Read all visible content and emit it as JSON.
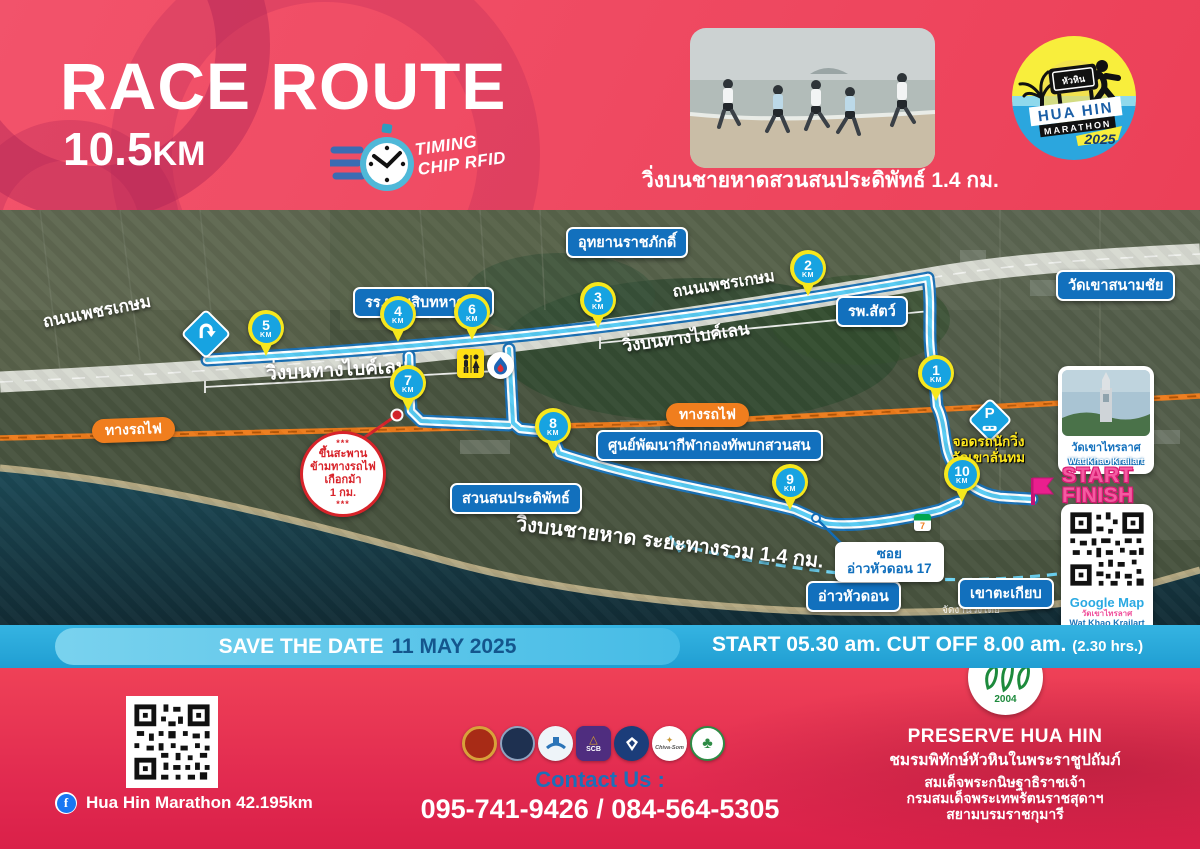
{
  "colors": {
    "header_pink": "#ee4257",
    "banner_blue": "#2fb0e0",
    "label_blue": "#1270bd",
    "route_cyan": "#57cbf3",
    "railway_orange": "#ee7c1c",
    "km_pin_yellow": "#f6e71d",
    "km_pin_blue": "#17a3e1",
    "start_finish_pink": "#f45ba1"
  },
  "header": {
    "title": "RACE ROUTE",
    "distance_value": "10.5",
    "distance_unit": "KM",
    "timing_line1": "TIMING",
    "timing_line2": "CHIP RFID",
    "photo_caption": "วิ่งบนชายหาดสวนสนประดิพัทธ์ 1.4 กม.",
    "logo": {
      "sign": "หัวหิน",
      "name1": "HUA HIN",
      "name2": "MARATHON",
      "year": "2025"
    }
  },
  "map": {
    "km_unit": "KM",
    "km_markers": [
      {
        "n": "1"
      },
      {
        "n": "2"
      },
      {
        "n": "3"
      },
      {
        "n": "4"
      },
      {
        "n": "5"
      },
      {
        "n": "6"
      },
      {
        "n": "7"
      },
      {
        "n": "8"
      },
      {
        "n": "9"
      },
      {
        "n": "10"
      }
    ],
    "road_phetkasem_left": "ถนนเพชรเกษม",
    "road_phetkasem_center": "ถนนเพชรเกษม",
    "railway_left": "ทางรถไฟ",
    "railway_right": "ทางรถไฟ",
    "bike_lane_left": "วิ่งบนทางไบค์เลน",
    "bike_lane_right": "วิ่งบนทางไบค์เลน",
    "beach_run": "วิ่งบนชายหาด ระยะทางรวม 1.4 กม.",
    "labels": {
      "army_school": "รร.นายสิบทหารบก",
      "rajabhakti": "อุทยานราชภักดิ์",
      "vet_hospital": "รพ.สัตว์",
      "wat_khao_sanamchai": "วัดเขาสนามชัย",
      "army_sports_center": "ศูนย์พัฒนากีฬากองทัพบกสวนสน",
      "suan_son": "สวนสนประดิพัทธ์",
      "ao_hua_don": "อ่าวหัวดอน",
      "khao_takiab": "เขาตะเกียบ",
      "soi_line1": "ซอย",
      "soi_line2": "อ่าวหัวดอน 17"
    },
    "parking_note_line1": "จอดรถนักวิ่ง",
    "parking_note_line2": "วัดเขาลั่นทม",
    "parking_icon_letter": "P",
    "seven_eleven": "7",
    "bridge_note": {
      "stars": "***",
      "line1": "ขึ้นสะพาน",
      "line2": "ข้ามทางรถไฟ",
      "line3": "เกือกม้า",
      "line4": "1 กม."
    },
    "start_label": "START",
    "finish_label": "FINISH",
    "temple_card": {
      "thai": "วัดเขาไทรลาศ",
      "eng": "Wat Khao Krailart"
    },
    "qr_card": {
      "title": "Google Map",
      "thai": "วัดเขาไทรลาศ",
      "eng": "Wat Khao Krailart"
    },
    "organizer_note": "จัดงานวิ่งโดย"
  },
  "banner": {
    "save_the_date": "SAVE THE DATE",
    "date": "11 MAY 2025",
    "start_info": "START 05.30 am. CUT OFF 8.00 am.",
    "duration": "(2.30 hrs.)"
  },
  "footer": {
    "facebook": "Hua Hin Marathon 42.195km",
    "contact_label": "Contact Us :",
    "phones": "095-741-9426 / 084-564-5305",
    "sponsors": {
      "scb": "SCB",
      "chiva_som": "Chiva-Som"
    },
    "preserve": {
      "year": "2004",
      "title": "PRESERVE HUA HIN",
      "line1": "ชมรมพิทักษ์หัวหินในพระราชูปถัมภ์",
      "line2": "สมเด็จพระกนิษฐาธิราชเจ้า",
      "line3": "กรมสมเด็จพระเทพรัตนราชสุดาฯ",
      "line4": "สยามบรมราชกุมารี"
    }
  }
}
